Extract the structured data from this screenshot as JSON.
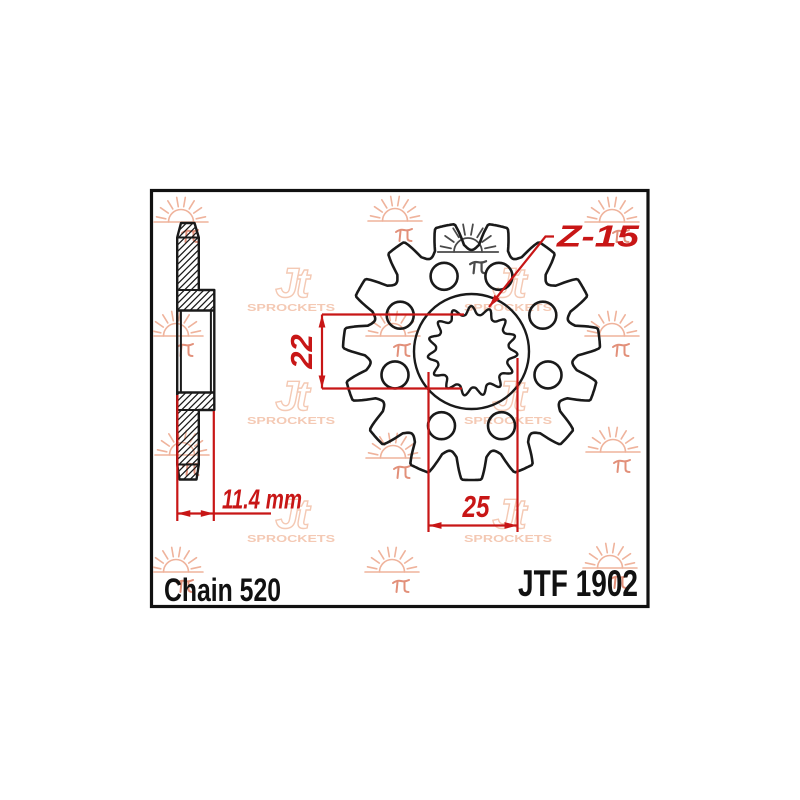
{
  "title_block": {
    "chain_label": "Chain 520",
    "part_number": "JTF 1902"
  },
  "dimensions": {
    "teeth_label": "Z-15",
    "inner_across_flats": "22",
    "outer_across_tips": "25",
    "overall_width": "11.4 mm"
  },
  "watermark": {
    "logo_text": "Jt",
    "logo_subtext": "SPROCKETS",
    "seal_glyph": "兀"
  },
  "colors": {
    "line_black": "#1a1a1a",
    "frame_black": "#111111",
    "dimension_red": "#c81616",
    "watermark_peach": "#efb39c",
    "watermark_light": "#f4c9b4",
    "watermark_mark": "#e2907a",
    "watermark_dark": "#4a4a4a",
    "background": "#ffffff"
  }
}
